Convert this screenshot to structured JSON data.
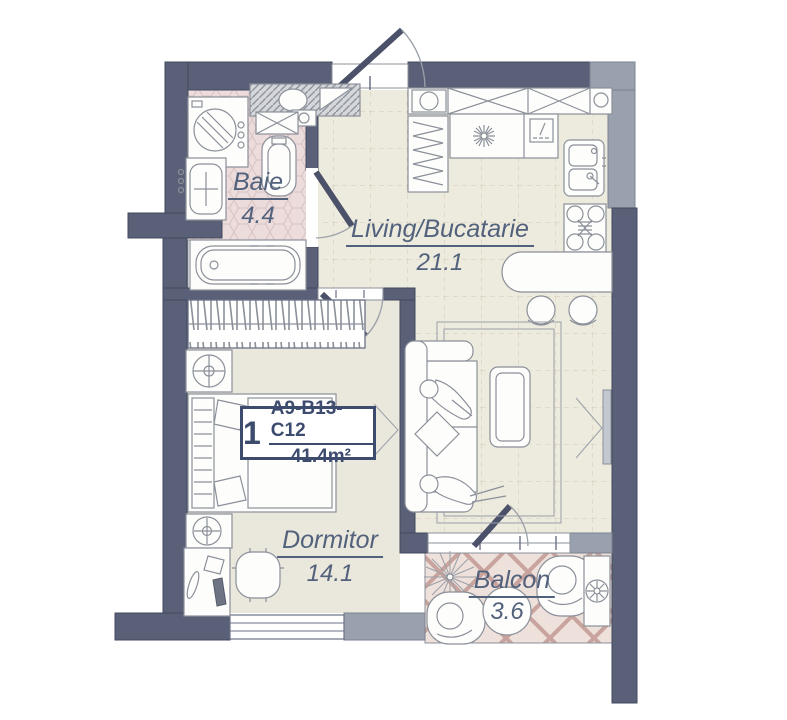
{
  "floor_plan": {
    "unit": {
      "number": "1",
      "code": "A9-B13-C12",
      "area": "41.4m²"
    },
    "rooms": [
      {
        "id": "baie",
        "name": "Baie",
        "area": "4.4"
      },
      {
        "id": "living",
        "name": "Living/Bucatarie",
        "area": "21.1"
      },
      {
        "id": "dormitor",
        "name": "Dormitor",
        "area": "14.1"
      },
      {
        "id": "balcon",
        "name": "Balcon",
        "area": "3.6"
      }
    ],
    "fixtures": {
      "bathroom": [
        "washing-machine",
        "vanity-sink",
        "toilet",
        "wall-sink",
        "bathtub"
      ],
      "kitchen": [
        "upper-cabinets",
        "fridge",
        "hood-counter",
        "dishwasher",
        "kitchen-sink",
        "stove",
        "bar-counter",
        "bar-stools"
      ],
      "living": [
        "rug",
        "sofa",
        "occupants",
        "pillow",
        "coffee-table",
        "tv"
      ],
      "bedroom": [
        "wardrobe",
        "nightstand-lamp",
        "bed",
        "desk",
        "desk-chair",
        "window"
      ],
      "balcony": [
        "plant",
        "armchair",
        "round-table",
        "ac-unit"
      ]
    },
    "colors": {
      "wall_dark": "#5a6077",
      "wall_light": "#9aa1ae",
      "floor_living": "#edeade",
      "floor_bathroom": "#ecdcdc",
      "floor_bedroom": "#eae7dc",
      "floor_balcony": "#eee1db",
      "label_text": "#52617c",
      "unit_text": "#3d4c6e"
    }
  }
}
